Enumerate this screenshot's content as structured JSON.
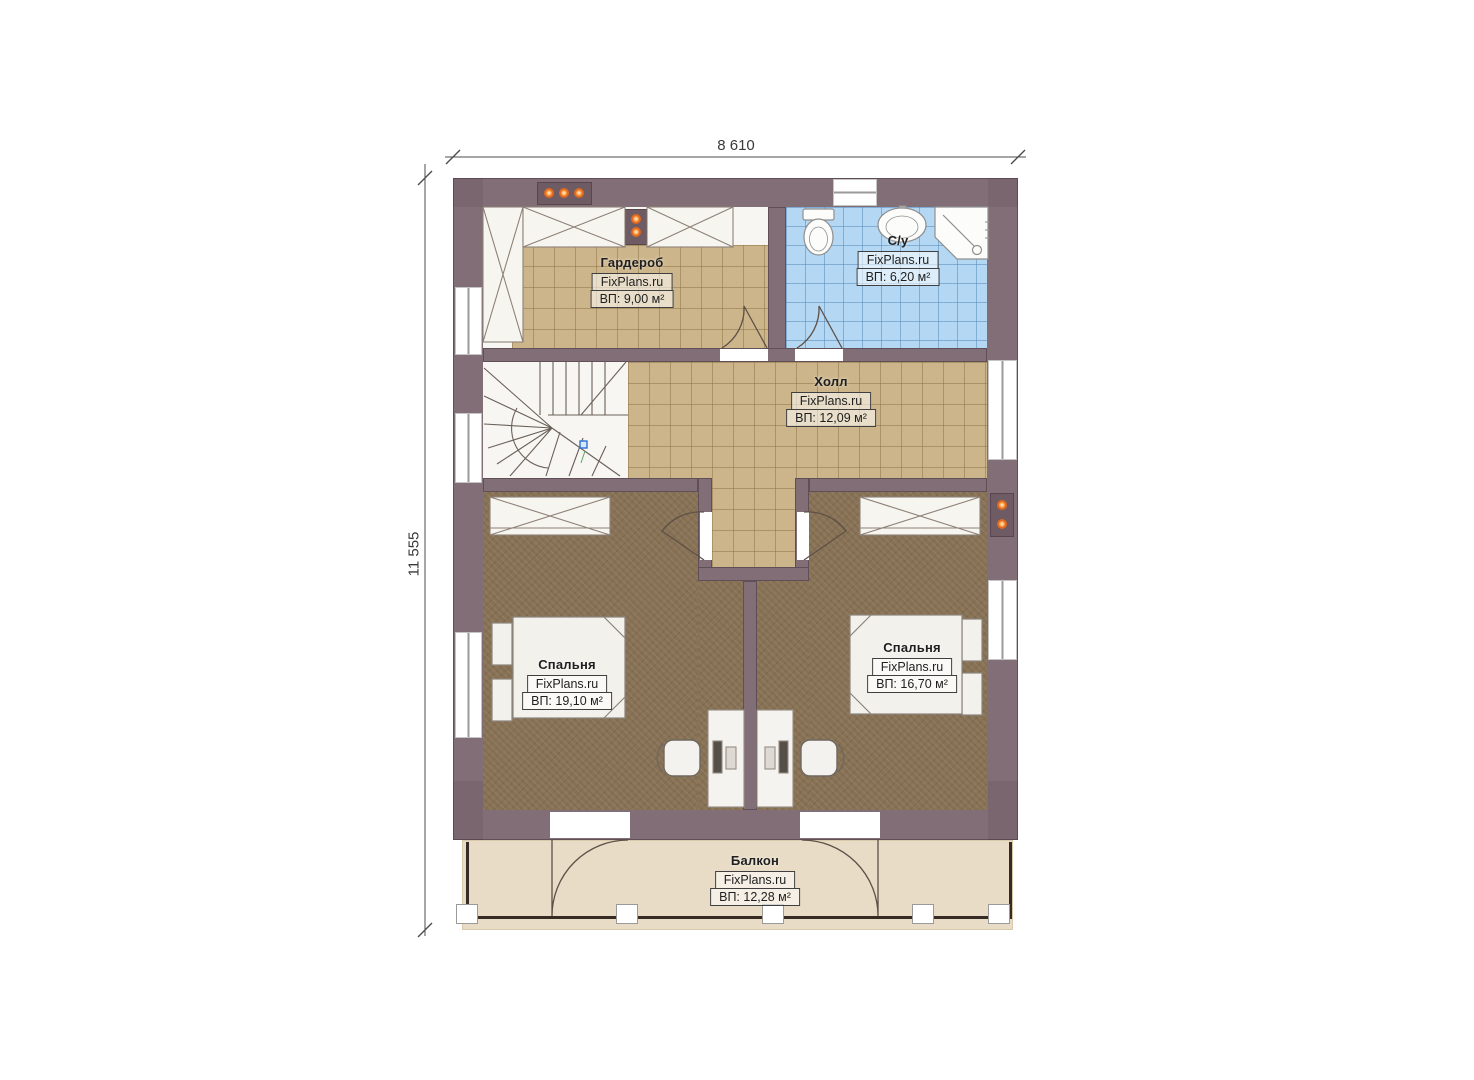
{
  "plan": {
    "dimension_width": "8 610",
    "dimension_height": "11 555"
  },
  "rooms": [
    {
      "name": "Гардероб",
      "brand": "FixPlans.ru",
      "area": "ВП: 9,00 м²"
    },
    {
      "name": "С/у",
      "brand": "FixPlans.ru",
      "area": "ВП: 6,20 м²"
    },
    {
      "name": "Холл",
      "brand": "FixPlans.ru",
      "area": "ВП: 12,09 м²"
    },
    {
      "name": "Спальня",
      "brand": "FixPlans.ru",
      "area": "ВП: 19,10 м²"
    },
    {
      "name": "Спальня",
      "brand": "FixPlans.ru",
      "area": "ВП: 16,70 м²"
    },
    {
      "name": "Балкон",
      "brand": "FixPlans.ru",
      "area": "ВП: 12,28 м²"
    }
  ],
  "colors": {
    "wall": "#826e76",
    "tile_floor": "#cdb58b",
    "bathroom_tile": "#b4d8f3",
    "bedroom_floor": "#877154",
    "balcony_floor": "#e8dcc6",
    "accent_lights": "#e06a1f",
    "stair_marker": "#2b6fd4"
  }
}
